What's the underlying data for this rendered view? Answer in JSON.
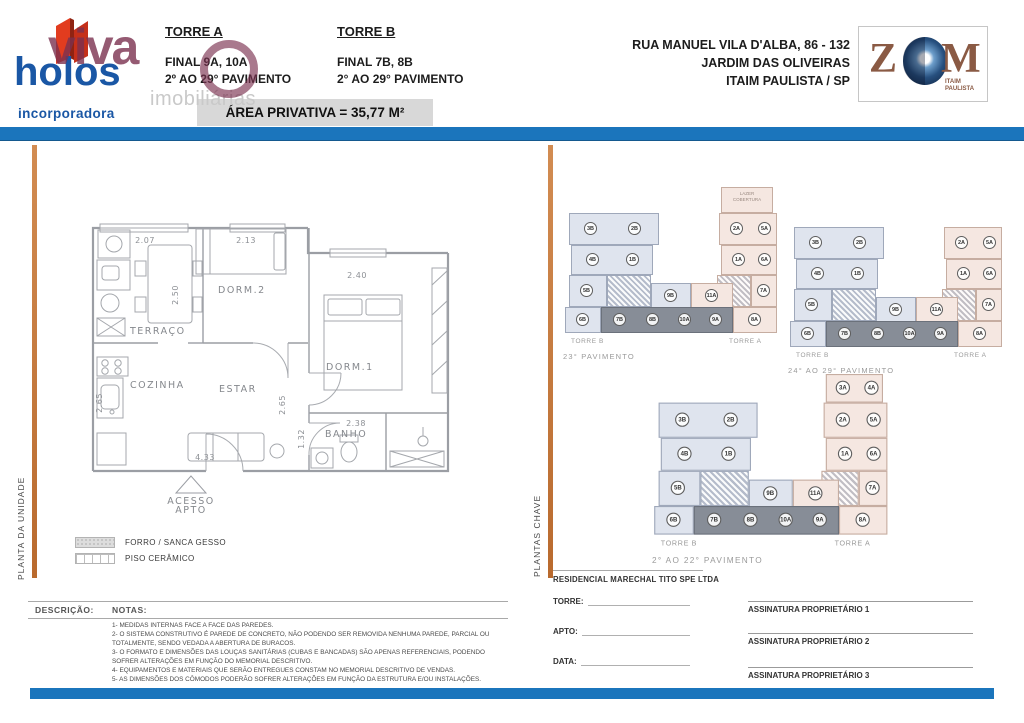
{
  "header": {
    "logo": {
      "watermark": "viva",
      "watermark2": "imobiliárias",
      "brand": "holos",
      "sub": "incorporadora"
    },
    "torre_a": {
      "title": "TORRE A",
      "final": "FINAL 9A, 10A",
      "range": "2º AO 29° PAVIMENTO"
    },
    "torre_b": {
      "title": "TORRE B",
      "final": "FINAL 7B, 8B",
      "range": "2° AO 29° PAVIMENTO"
    },
    "area_privativa": "ÁREA PRIVATIVA =  35,77 M²",
    "address": [
      "RUA MANUEL VILA D'ALBA, 86 - 132",
      "JARDIM DAS OLIVEIRAS",
      "ITAIM PAULISTA / SP"
    ],
    "zom": {
      "z": "Z",
      "m": "M",
      "city": "ITAIM\nPAULISTA"
    }
  },
  "unit_plan": {
    "side_label": "PLANTA DA UNIDADE",
    "rooms": {
      "terraco": "TERRAÇO",
      "cozinha": "COZINHA",
      "estar": "ESTAR",
      "dorm2": "DORM.2",
      "dorm1": "DORM.1",
      "banho": "BANHO"
    },
    "dimensions": {
      "terraco_width": "2.07",
      "terraco_depth": "2.50",
      "dorm2_width": "2.13",
      "dorm1_width": "2.40",
      "estar_width": "4.33",
      "estar_depth": "2.65",
      "cozinha_depth": "2.65",
      "banho_width": "2.38",
      "banho_depth": "1.32"
    },
    "access_line1": "ACESSO",
    "access_line2": "APTO",
    "legend": [
      {
        "label": "FORRO / SANCA GESSO"
      },
      {
        "label": "PISO CERÂMICO"
      }
    ],
    "descricao_label": "DESCRIÇÃO:",
    "notas_label": "NOTAS:",
    "notes": [
      "1- MEDIDAS INTERNAS FACE A FACE DAS PAREDES.",
      "2- O SISTEMA CONSTRUTIVO É PAREDE DE CONCRETO, NÃO PODENDO SER REMOVIDA NENHUMA PAREDE, PARCIAL OU TOTALMENTE, SENDO VEDADA A ABERTURA DE BURACOS.",
      "3- O FORMATO E DIMENSÕES DAS LOUÇAS SANITÁRIAS (CUBAS E BANCADAS) SÃO APENAS REFERENCIAIS, PODENDO SOFRER ALTERAÇÕES EM FUNÇÃO DO MEMORIAL DESCRITIVO.",
      "4- EQUIPAMENTOS E MATERIAIS QUE SERÃO ENTREGUES CONSTAM NO MEMORIAL DESCRITIVO DE VENDAS.",
      "5- AS DIMENSÕES DOS CÔMODOS PODERÃO SOFRER ALTERAÇÕES EM FUNÇÃO DA ESTRUTURA E/OU INSTALAÇÕES."
    ]
  },
  "key_plans": {
    "side_label": "PLANTAS CHAVE",
    "plans": [
      {
        "floor_label": "23° PAVIMENTO",
        "torre_b": "TORRE B",
        "torre_a": "TORRE A",
        "top": "lazer",
        "roof_text": [
          "LAZER",
          "COBERTURA"
        ],
        "units": {
          "b_top": [
            "3B",
            "2B"
          ],
          "b_mid": [
            "4B",
            "1B"
          ],
          "b_low": [
            "5B"
          ],
          "b_bot": [
            "6B"
          ],
          "band_b": [
            "9B"
          ],
          "band_a": [
            "11A"
          ],
          "dark": [
            "7B",
            "8B",
            "10A",
            "9A"
          ],
          "a_bot": [
            "8A"
          ],
          "a_low": [
            "7A"
          ],
          "a_mid": [
            "1A",
            "6A"
          ],
          "a_top": [
            "2A",
            "5A"
          ]
        }
      },
      {
        "floor_label": "24° AO 29° PAVIMENTO",
        "torre_b": "TORRE B",
        "torre_a": "TORRE A",
        "top": "none",
        "units": {
          "b_top": [
            "3B",
            "2B"
          ],
          "b_mid": [
            "4B",
            "1B"
          ],
          "b_low": [
            "5B"
          ],
          "b_bot": [
            "6B"
          ],
          "band_b": [
            "9B"
          ],
          "band_a": [
            "11A"
          ],
          "dark": [
            "7B",
            "8B",
            "10A",
            "9A"
          ],
          "a_bot": [
            "8A"
          ],
          "a_low": [
            "7A"
          ],
          "a_mid": [
            "1A",
            "6A"
          ],
          "a_top": [
            "2A",
            "5A"
          ]
        }
      },
      {
        "floor_label": "2° AO 22° PAVIMENTO",
        "torre_b": "TORRE B",
        "torre_a": "TORRE A",
        "top": "units",
        "roof_units": [
          "3A",
          "4A"
        ],
        "units": {
          "b_top": [
            "3B",
            "2B"
          ],
          "b_mid": [
            "4B",
            "1B"
          ],
          "b_low": [
            "5B"
          ],
          "b_bot": [
            "6B"
          ],
          "band_b": [
            "9B"
          ],
          "band_a": [
            "11A"
          ],
          "dark": [
            "7B",
            "8B",
            "10A",
            "9A"
          ],
          "a_bot": [
            "8A"
          ],
          "a_low": [
            "7A"
          ],
          "a_mid": [
            "1A",
            "6A"
          ],
          "a_top": [
            "2A",
            "5A"
          ]
        }
      }
    ]
  },
  "footer": {
    "company": "RESIDENCIAL MARECHAL TITO SPE LTDA",
    "fields": [
      "TORRE:",
      "APTO:",
      "DATA:"
    ],
    "signatures": [
      "ASSINATURA PROPRIETÁRIO 1",
      "ASSINATURA PROPRIETÁRIO 2",
      "ASSINATURA PROPRIETÁRIO 3"
    ]
  },
  "colors": {
    "accent_blue": "#1b75bc",
    "accent_orange": "#c9803f",
    "torre_b_fill": "#dfe4ee",
    "torre_a_fill": "#f5e7e1",
    "highlight_fill": "#878d97",
    "brand_blue": "#1a57a5",
    "brand_red": "#e23c1f",
    "watermark_maroon": "#7b3150",
    "zom_brown": "#8a5a44"
  }
}
